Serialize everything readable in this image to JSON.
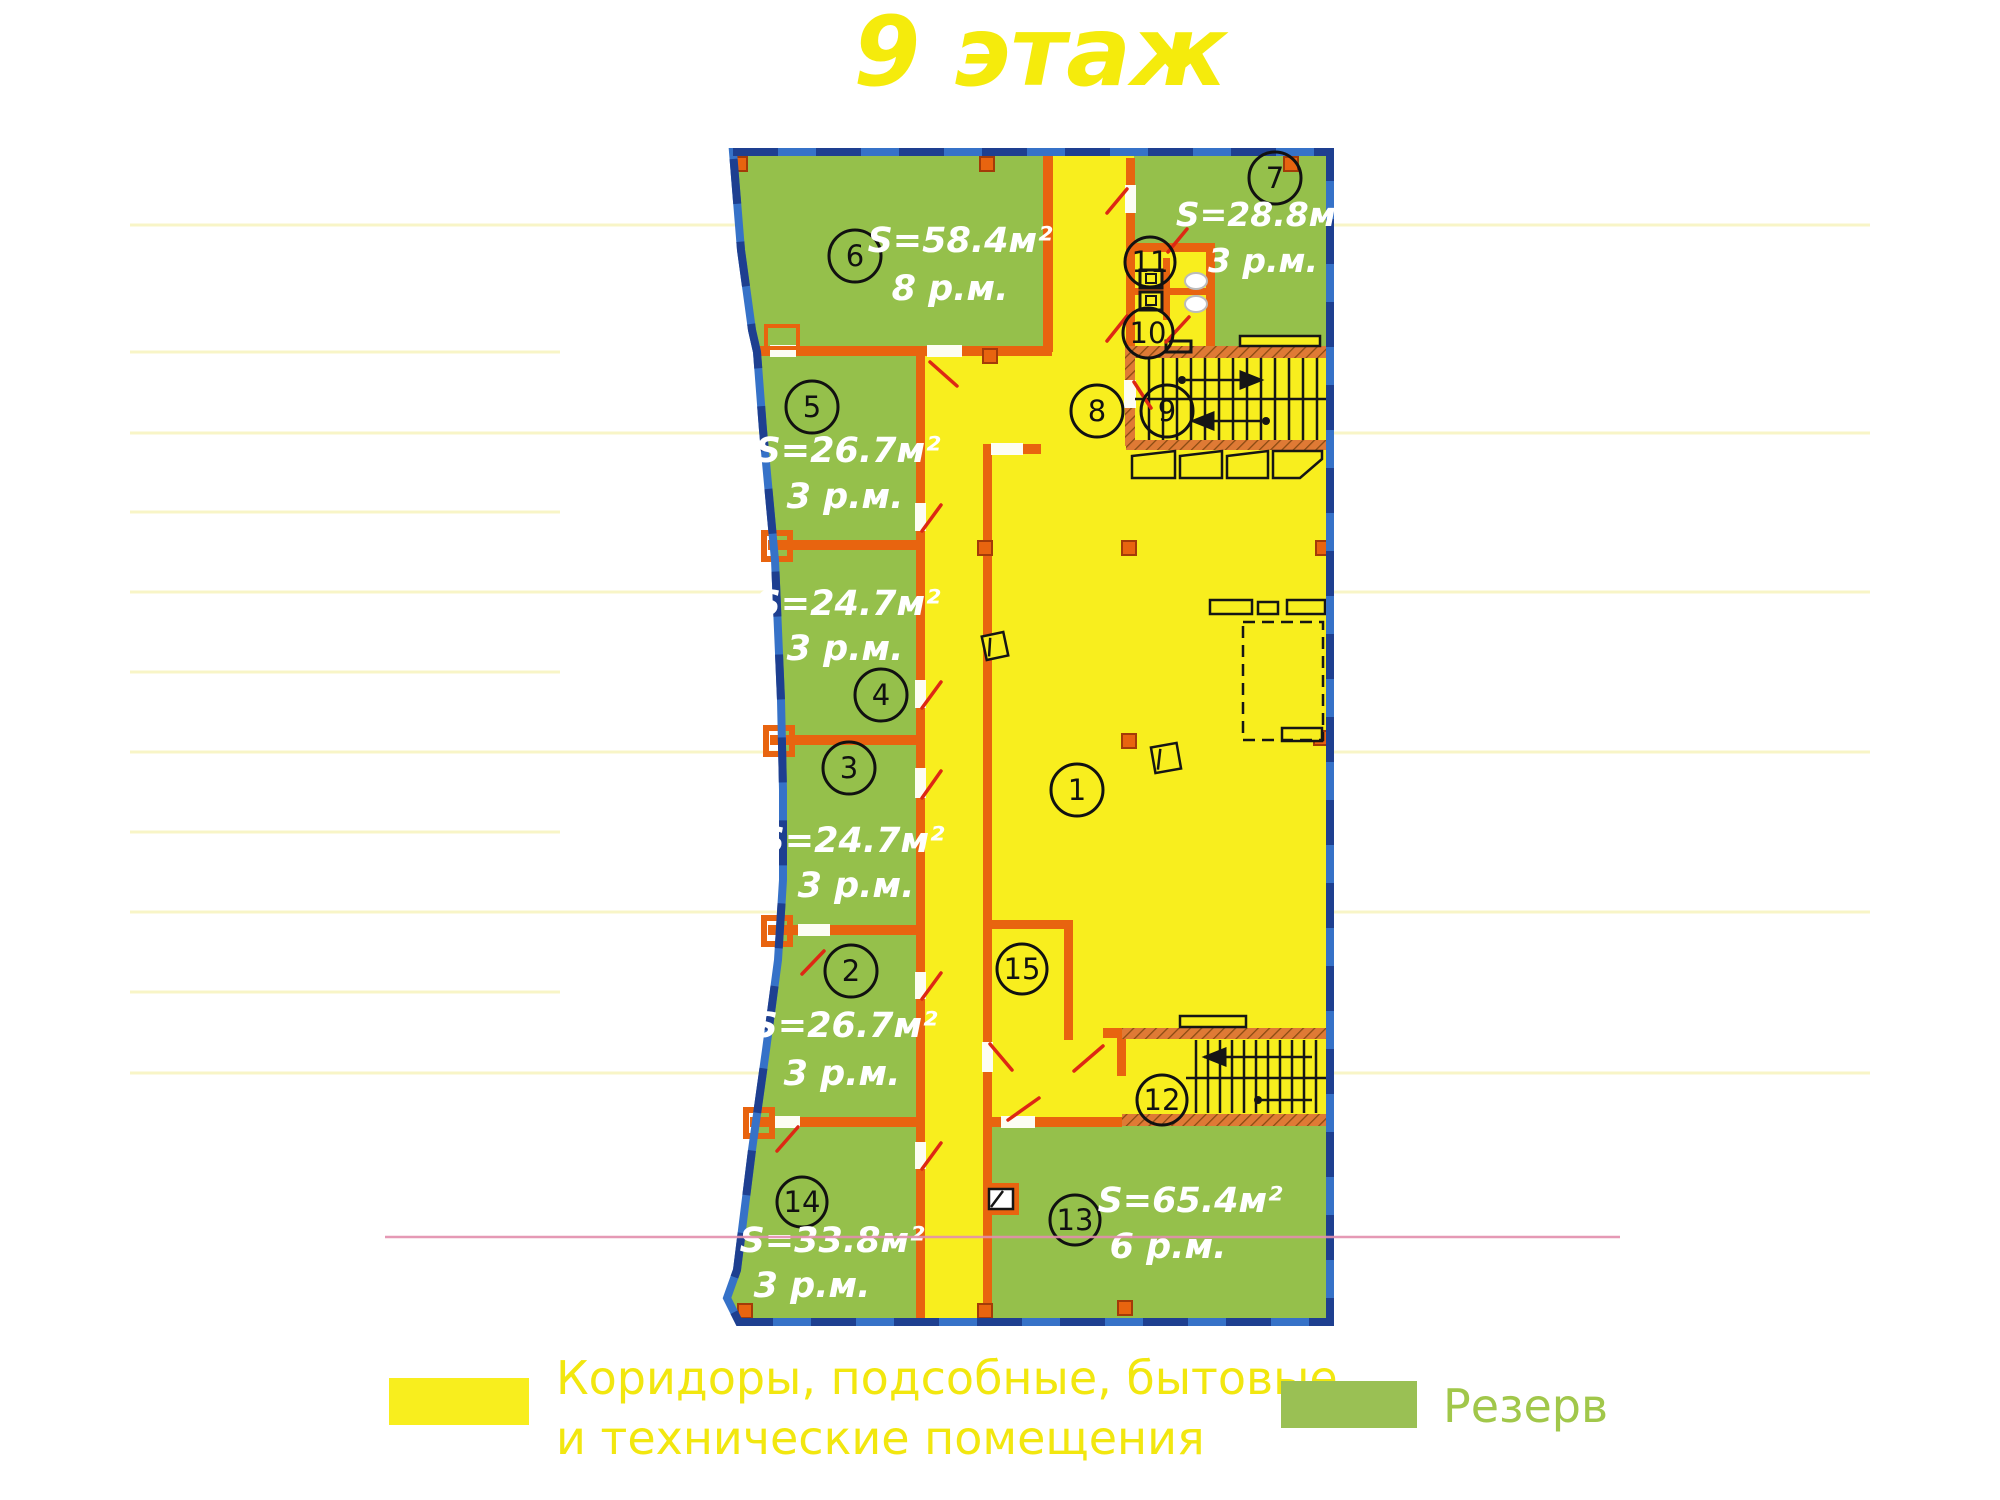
{
  "title": "9 этаж",
  "rooms": {
    "r1": {
      "number": "1"
    },
    "r2": {
      "number": "2",
      "area": "S=26.7м²",
      "parking": "3 р.м."
    },
    "r3": {
      "number": "3",
      "area": "S=24.7м²",
      "parking": "3 р.м."
    },
    "r4": {
      "number": "4",
      "area": "S=24.7м²",
      "parking": "3 р.м."
    },
    "r5": {
      "number": "5",
      "area": "S=26.7м²",
      "parking": "3 р.м."
    },
    "r6": {
      "number": "6",
      "area": "S=58.4м²",
      "parking": "8 р.м."
    },
    "r7": {
      "number": "7",
      "area": "S=28.8м²",
      "parking": "3 р.м."
    },
    "r8": {
      "number": "8"
    },
    "r9": {
      "number": "9"
    },
    "r10": {
      "number": "10"
    },
    "r11": {
      "number": "11"
    },
    "r12": {
      "number": "12"
    },
    "r13": {
      "number": "13",
      "area": "S=65.4м²",
      "parking": "6 р.м."
    },
    "r14": {
      "number": "14",
      "area": "S=33.8м²",
      "parking": "3 р.м."
    },
    "r15": {
      "number": "15"
    }
  },
  "legend": {
    "corridor": {
      "line1": "Коридоры, подсобные, бытовые",
      "line2": "и технические помещения"
    },
    "reserve": {
      "label": "Резерв"
    }
  },
  "colors": {
    "corridor_yellow": "#f8ee1e",
    "reserve_green": "#95c04b",
    "wall_orange": "#e8640f",
    "outline_blue": "#3672c8",
    "outline_blue_dark": "#1e3f90",
    "door_red": "#dd2814",
    "title_yellow": "#f5eb0c",
    "legend_text_yellow": "#f2e70f",
    "legend_text_green": "#a1c74a",
    "scan_line_pink": "#e38fae"
  }
}
